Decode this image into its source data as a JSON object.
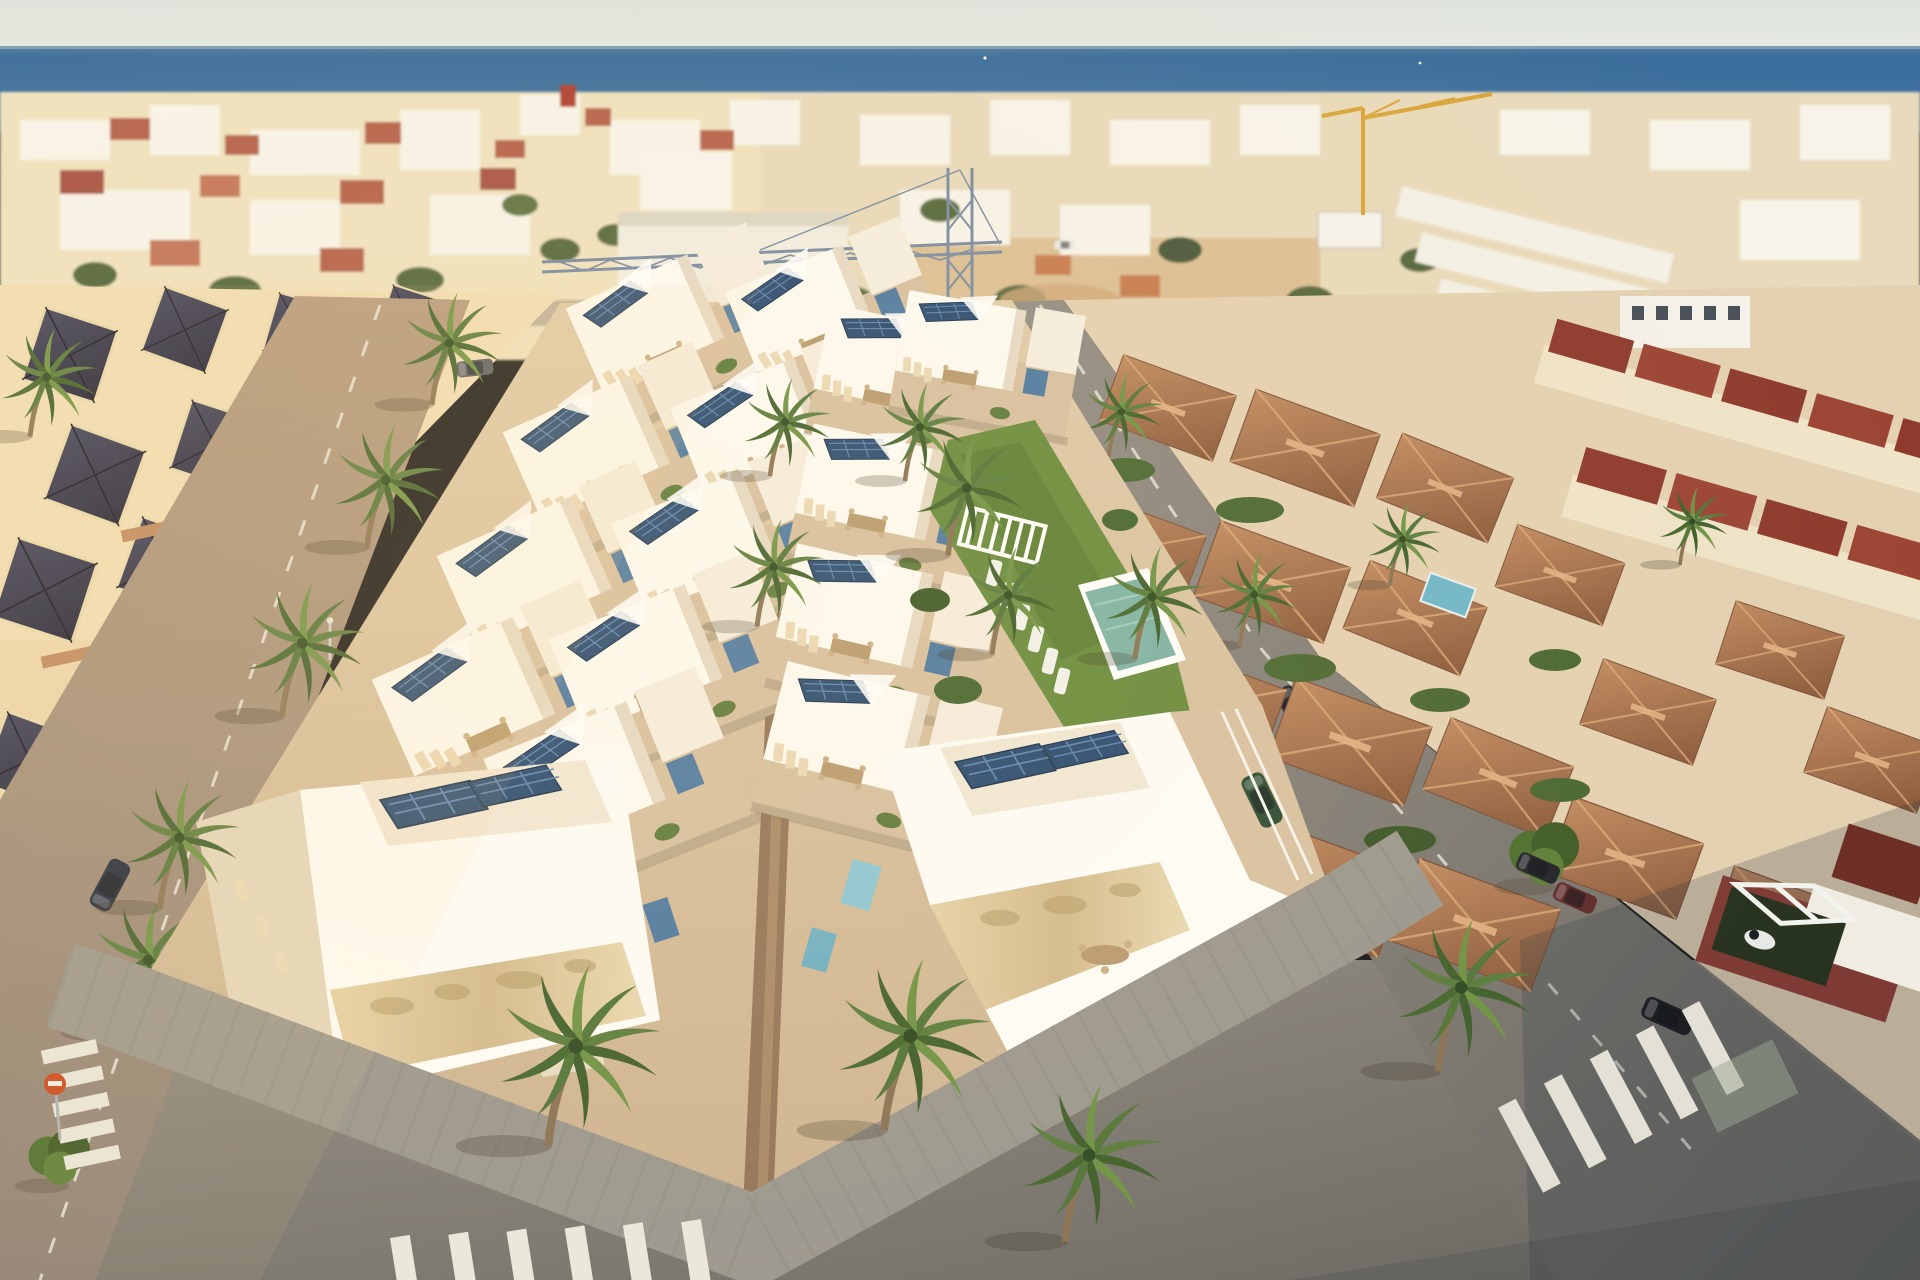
{
  "meta": {
    "title": "Aerial architectural render of a new-build villa development by the sea",
    "kind": "photograph-render",
    "visible_text": "none"
  },
  "palette": {
    "sky_top": "#dfe4de",
    "sky_horizon": "#edefe7",
    "sea_deep": "#2c5c8e",
    "sea_mid": "#3f719f",
    "town_beige": "#e8dabb",
    "town_white": "#f8f4ea",
    "roof_red": "#b5624c",
    "roof_maroon": "#8e3b2e",
    "sand": "#dcc095",
    "terrace_tan": "#d7c0a1",
    "walkway_brown": "#93755a",
    "villa_white": "#fdfbf4",
    "solar_blue": "#2a4b72",
    "accent_steel_blue": "#4e7aa2",
    "accent_cyan": "#8ec7d6",
    "lawn_green": "#688b3d",
    "pool_teal": "#7fb3a6",
    "stone_clad": "#dcc79d",
    "road_warm": "#a8907a",
    "road_grey": "#7b7973",
    "sidewalk_grey": "#9c988f",
    "palm_green": "#53753a",
    "palm_trunk": "#8a7355",
    "tile_roof": "#a76f4c",
    "crane_blue": "#7b8ca2",
    "crane_yellow": "#d9a63c",
    "marking_white": "#eae7dc",
    "sign_red": "#cc4a21",
    "shade_cool": "#263042"
  },
  "scene": {
    "sky": {
      "label": "pale hazy morning sky"
    },
    "sea": {
      "label": "Mediterranean sea band across horizon",
      "boats": 2
    },
    "distant_town": {
      "label": "dense low-rise coastal town",
      "features": [
        "white and beige houses",
        "scattered red tile roofs",
        "palm-lined avenues",
        "white warehouse block",
        "sandy construction lot",
        "yellow tower crane",
        "billboard"
      ]
    },
    "construction_crane": {
      "label": "blue lattice tower crane with long jib over new development"
    },
    "development": {
      "label": "two rows of modern white villas under construction/new",
      "left_block_villa_rows": 9,
      "right_block_villa_rows": 5,
      "features": [
        "flat roofs with dark blue solar panel arrays",
        "tan roof terraces with dining sets and loungers",
        "white shade sails",
        "steel-blue stair boxes",
        "central brown pedestrian walkway",
        "white perimeter wall with stone cladding",
        "foreground palm trees"
      ]
    },
    "communal_garden": {
      "label": "shared garden between villa rows",
      "features": [
        "lawn",
        "palms and banana plants",
        "white pergola bench",
        "row of 6 white sun loungers",
        "teal swimming pool"
      ]
    },
    "right_neighborhood": {
      "label": "existing villas with terracotta hip roofs",
      "features": [
        "red gable row houses",
        "private plunge pool",
        "hedges",
        "shaded foreground street"
      ]
    },
    "streets": {
      "label": "surrounding streets",
      "crosswalks": 3,
      "no_entry_sign": 1,
      "street_lamps": 8,
      "parked_cars": [
        "white",
        "navy",
        "silver",
        "dark grey",
        "green (in carport)",
        "black",
        "dark red",
        "dark blue"
      ]
    },
    "palms": {
      "label": "palm trees along sidewalks and garden",
      "count_approx": 20
    }
  }
}
